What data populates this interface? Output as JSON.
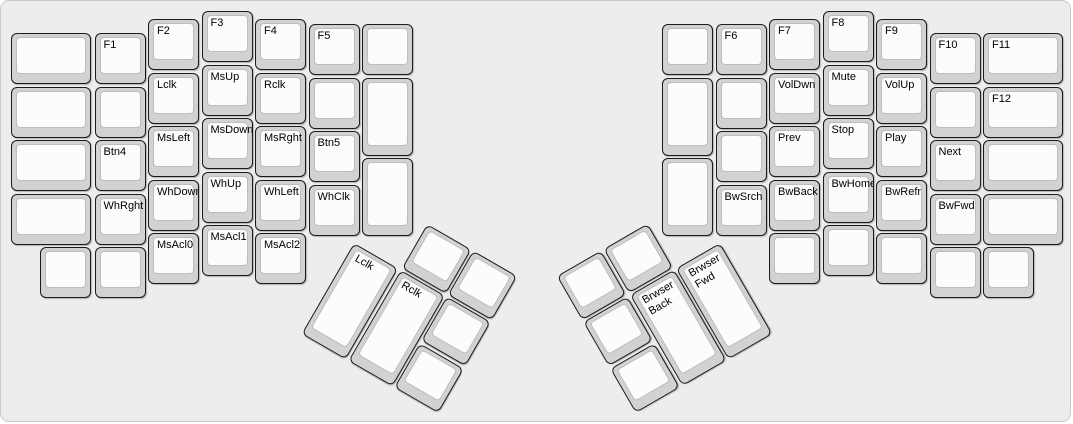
{
  "board": {
    "width": 1073,
    "height": 424,
    "background": "#ededed",
    "border_color": "#c9c9c9",
    "key_base_color": "#d2d2d2",
    "key_face_color": "#fcfcfc",
    "key_outline_color": "#1b1b1b",
    "key_face_outline_color": "#bdbdbd",
    "label_color": "#000000"
  },
  "keys": [
    {
      "label": "",
      "x": 10,
      "y": 32,
      "w": 80,
      "h": 51
    },
    {
      "label": "",
      "x": 10,
      "y": 85.5,
      "w": 80,
      "h": 51
    },
    {
      "label": "",
      "x": 10,
      "y": 139,
      "w": 80,
      "h": 51
    },
    {
      "label": "",
      "x": 10,
      "y": 192.5,
      "w": 80,
      "h": 51
    },
    {
      "label": "",
      "x": 39,
      "y": 246,
      "w": 51,
      "h": 51
    },
    {
      "label": "F1",
      "x": 93.5,
      "y": 32,
      "w": 51,
      "h": 51
    },
    {
      "label": "",
      "x": 93.5,
      "y": 85.5,
      "w": 51,
      "h": 51
    },
    {
      "label": "Btn4",
      "x": 93.5,
      "y": 139,
      "w": 51,
      "h": 51
    },
    {
      "label": "WhRght",
      "x": 93.5,
      "y": 192.5,
      "w": 51,
      "h": 51
    },
    {
      "label": "",
      "x": 93.5,
      "y": 246,
      "w": 51,
      "h": 51
    },
    {
      "label": "F2",
      "x": 147,
      "y": 18,
      "w": 51,
      "h": 51
    },
    {
      "label": "Lclk",
      "x": 147,
      "y": 71.5,
      "w": 51,
      "h": 51
    },
    {
      "label": "MsLeft",
      "x": 147,
      "y": 125,
      "w": 51,
      "h": 51
    },
    {
      "label": "WhDown",
      "x": 147,
      "y": 178.5,
      "w": 51,
      "h": 51
    },
    {
      "label": "MsAcl0",
      "x": 147,
      "y": 232,
      "w": 51,
      "h": 51
    },
    {
      "label": "F3",
      "x": 200.5,
      "y": 10,
      "w": 51,
      "h": 51
    },
    {
      "label": "MsUp",
      "x": 200.5,
      "y": 63.5,
      "w": 51,
      "h": 51
    },
    {
      "label": "MsDown",
      "x": 200.5,
      "y": 117,
      "w": 51,
      "h": 51
    },
    {
      "label": "WhUp",
      "x": 200.5,
      "y": 170.5,
      "w": 51,
      "h": 51
    },
    {
      "label": "MsAcl1",
      "x": 200.5,
      "y": 224,
      "w": 51,
      "h": 51
    },
    {
      "label": "F4",
      "x": 254,
      "y": 18,
      "w": 51,
      "h": 51
    },
    {
      "label": "Rclk",
      "x": 254,
      "y": 71.5,
      "w": 51,
      "h": 51
    },
    {
      "label": "MsRght",
      "x": 254,
      "y": 125,
      "w": 51,
      "h": 51
    },
    {
      "label": "WhLeft",
      "x": 254,
      "y": 178.5,
      "w": 51,
      "h": 51
    },
    {
      "label": "MsAcl2",
      "x": 254,
      "y": 232,
      "w": 51,
      "h": 51
    },
    {
      "label": "F5",
      "x": 307.5,
      "y": 23,
      "w": 51,
      "h": 51
    },
    {
      "label": "",
      "x": 307.5,
      "y": 76.5,
      "w": 51,
      "h": 51
    },
    {
      "label": "Btn5",
      "x": 307.5,
      "y": 130,
      "w": 51,
      "h": 51
    },
    {
      "label": "WhClk",
      "x": 307.5,
      "y": 183.5,
      "w": 51,
      "h": 51
    },
    {
      "label": "",
      "x": 361,
      "y": 23,
      "w": 51,
      "h": 51
    },
    {
      "label": "",
      "x": 361,
      "y": 76.5,
      "w": 51,
      "h": 78
    },
    {
      "label": "",
      "x": 361,
      "y": 157,
      "w": 51,
      "h": 78
    },
    {
      "label": "",
      "x": 661,
      "y": 23,
      "w": 51,
      "h": 51
    },
    {
      "label": "",
      "x": 661,
      "y": 76.5,
      "w": 51,
      "h": 78
    },
    {
      "label": "",
      "x": 661,
      "y": 157,
      "w": 51,
      "h": 78
    },
    {
      "label": "F6",
      "x": 714.5,
      "y": 23,
      "w": 51,
      "h": 51
    },
    {
      "label": "",
      "x": 714.5,
      "y": 76.5,
      "w": 51,
      "h": 51
    },
    {
      "label": "",
      "x": 714.5,
      "y": 130,
      "w": 51,
      "h": 51
    },
    {
      "label": "BwSrch",
      "x": 714.5,
      "y": 183.5,
      "w": 51,
      "h": 51
    },
    {
      "label": "F7",
      "x": 768,
      "y": 18,
      "w": 51,
      "h": 51
    },
    {
      "label": "VolDwn",
      "x": 768,
      "y": 71.5,
      "w": 51,
      "h": 51
    },
    {
      "label": "Prev",
      "x": 768,
      "y": 125,
      "w": 51,
      "h": 51
    },
    {
      "label": "BwBack",
      "x": 768,
      "y": 178.5,
      "w": 51,
      "h": 51
    },
    {
      "label": "",
      "x": 768,
      "y": 232,
      "w": 51,
      "h": 51
    },
    {
      "label": "F8",
      "x": 821.5,
      "y": 10,
      "w": 51,
      "h": 51
    },
    {
      "label": "Mute",
      "x": 821.5,
      "y": 63.5,
      "w": 51,
      "h": 51
    },
    {
      "label": "Stop",
      "x": 821.5,
      "y": 117,
      "w": 51,
      "h": 51
    },
    {
      "label": "BwHome",
      "x": 821.5,
      "y": 170.5,
      "w": 51,
      "h": 51
    },
    {
      "label": "",
      "x": 821.5,
      "y": 224,
      "w": 51,
      "h": 51
    },
    {
      "label": "F9",
      "x": 875,
      "y": 18,
      "w": 51,
      "h": 51
    },
    {
      "label": "VolUp",
      "x": 875,
      "y": 71.5,
      "w": 51,
      "h": 51
    },
    {
      "label": "Play",
      "x": 875,
      "y": 125,
      "w": 51,
      "h": 51
    },
    {
      "label": "BwRefr",
      "x": 875,
      "y": 178.5,
      "w": 51,
      "h": 51
    },
    {
      "label": "",
      "x": 875,
      "y": 232,
      "w": 51,
      "h": 51
    },
    {
      "label": "F10",
      "x": 928.5,
      "y": 32,
      "w": 51,
      "h": 51
    },
    {
      "label": "",
      "x": 928.5,
      "y": 85.5,
      "w": 51,
      "h": 51
    },
    {
      "label": "Next",
      "x": 928.5,
      "y": 139,
      "w": 51,
      "h": 51
    },
    {
      "label": "BwFwd",
      "x": 928.5,
      "y": 192.5,
      "w": 51,
      "h": 51
    },
    {
      "label": "",
      "x": 928.5,
      "y": 246,
      "w": 51,
      "h": 51
    },
    {
      "label": "F11",
      "x": 982,
      "y": 32,
      "w": 80,
      "h": 51
    },
    {
      "label": "F12",
      "x": 982,
      "y": 85.5,
      "w": 80,
      "h": 51
    },
    {
      "label": "",
      "x": 982,
      "y": 139,
      "w": 80,
      "h": 51
    },
    {
      "label": "",
      "x": 982,
      "y": 192.5,
      "w": 80,
      "h": 51
    },
    {
      "label": "",
      "x": 982,
      "y": 246,
      "w": 51,
      "h": 51
    }
  ],
  "thumb_clusters": [
    {
      "name": "left-thumb-cluster",
      "origin_x": 353,
      "origin_y": 242,
      "rotation": 30,
      "keys": [
        {
          "label": "",
          "x": 53.5,
          "y": -53.5,
          "w": 51,
          "h": 51
        },
        {
          "label": "",
          "x": 107,
          "y": -53.5,
          "w": 51,
          "h": 51
        },
        {
          "label": "Lclk",
          "x": 0,
          "y": 0,
          "w": 51,
          "h": 105
        },
        {
          "label": "Rclk",
          "x": 53.5,
          "y": 0,
          "w": 51,
          "h": 105
        },
        {
          "label": "",
          "x": 107,
          "y": 0,
          "w": 51,
          "h": 51
        },
        {
          "label": "",
          "x": 107,
          "y": 53.5,
          "w": 51,
          "h": 51
        }
      ]
    },
    {
      "name": "right-thumb-cluster",
      "origin_x": 719,
      "origin_y": 242,
      "rotation": -30,
      "keys": [
        {
          "label": "",
          "x": -158,
          "y": -53.5,
          "w": 51,
          "h": 51
        },
        {
          "label": "",
          "x": -104.5,
          "y": -53.5,
          "w": 51,
          "h": 51
        },
        {
          "label": "Brwser\nBack",
          "x": -104.5,
          "y": 0,
          "w": 51,
          "h": 105
        },
        {
          "label": "Brwser\nFwd",
          "x": -51,
          "y": 0,
          "w": 51,
          "h": 105
        },
        {
          "label": "",
          "x": -158,
          "y": 0,
          "w": 51,
          "h": 51
        },
        {
          "label": "",
          "x": -158,
          "y": 53.5,
          "w": 51,
          "h": 51
        }
      ]
    }
  ]
}
